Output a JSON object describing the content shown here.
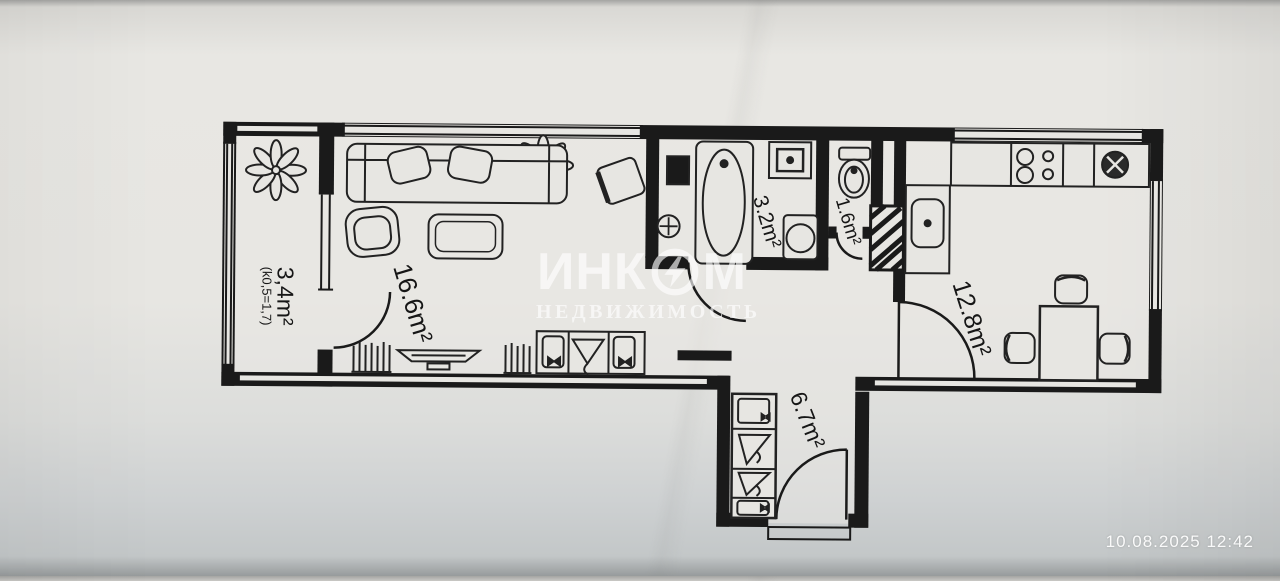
{
  "photo": {
    "timestamp": "10.08.2025 12:42"
  },
  "watermark": {
    "brand_prefix": "ИНК",
    "brand_suffix": "М",
    "subtitle": "НЕДВИЖИМОСТЬ"
  },
  "rooms": {
    "living": {
      "area": "16.6m²"
    },
    "bathroom": {
      "area": "3.2m²"
    },
    "wc": {
      "area": "1.6m²"
    },
    "kitchen": {
      "area": "12.8m²"
    },
    "hallway": {
      "area": "6.7m²"
    },
    "balcony": {
      "area": "3,4m²",
      "coefficient": "(k0,5=1,7)"
    }
  },
  "colors": {
    "ink": "#1a1a1a",
    "paper": "#e7e6e2",
    "watermark": "#ffffff"
  },
  "icons": [
    "flower-plant-icon",
    "sofa-icon",
    "armchair-icon",
    "coffee-table-icon",
    "desk-chair-icon",
    "tv-icon",
    "bookshelf-icon",
    "wardrobe-icon",
    "hanger-icon",
    "shoe-shelf-icon",
    "bathtub-icon",
    "washing-machine-icon",
    "water-heater-icon",
    "floor-drain-icon",
    "washbasin-icon",
    "toilet-icon",
    "ventilation-shaft",
    "kitchen-sink-icon",
    "stove-icon",
    "appliance-icon",
    "dining-table-icon",
    "chair-icon",
    "door-arc-icon",
    "window-icon",
    "logo-bolt-icon"
  ]
}
